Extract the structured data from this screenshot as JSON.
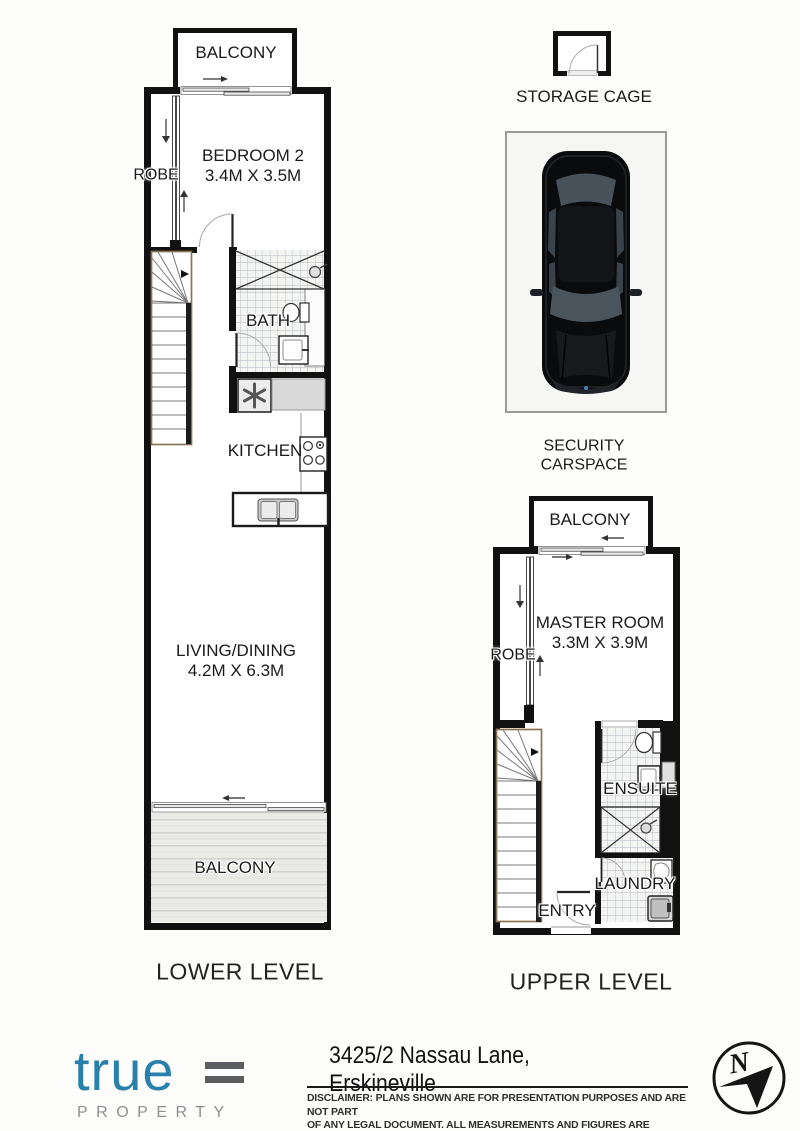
{
  "lower_level": {
    "balcony_top": "BALCONY",
    "bedroom2": {
      "name": "BEDROOM 2",
      "dims": "3.4M X 3.5M"
    },
    "robe": "ROBE",
    "bath": "BATH",
    "kitchen": "KITCHEN",
    "living": {
      "name": "LIVING/DINING",
      "dims": "4.2M X 6.3M"
    },
    "balcony_bottom": "BALCONY",
    "caption": "LOWER LEVEL"
  },
  "upper_level": {
    "balcony": "BALCONY",
    "master": {
      "name": "MASTER ROOM",
      "dims": "3.3M X 3.9M"
    },
    "robe": "ROBE",
    "ensuite": "ENSUITE",
    "laundry": "LAUNDRY",
    "entry": "ENTRY",
    "caption": "UPPER LEVEL"
  },
  "storage": {
    "label": "STORAGE CAGE"
  },
  "carspace": {
    "line1": "SECURITY",
    "line2": "CARSPACE"
  },
  "footer": {
    "logo_word": "true",
    "logo_sub": "PROPERTY",
    "address": "3425/2 Nassau Lane, Erskineville",
    "disclaimer_line1": "DISCLAIMER:  PLANS SHOWN ARE FOR PRESENTATION PURPOSES AND ARE NOT PART",
    "disclaimer_line2": "OF ANY LEGAL DOCUMENT. ALL MEASUREMENTS AND FIGURES ARE APPROXIMATE.",
    "compass_n": "N"
  },
  "colors": {
    "wall": "#111111",
    "tile_line": "#aeb6be",
    "deck": "#e9e9e6",
    "logo_blue": "#2980ab",
    "logo_gray": "#8d9093",
    "car_body": "#0a0b0d"
  }
}
